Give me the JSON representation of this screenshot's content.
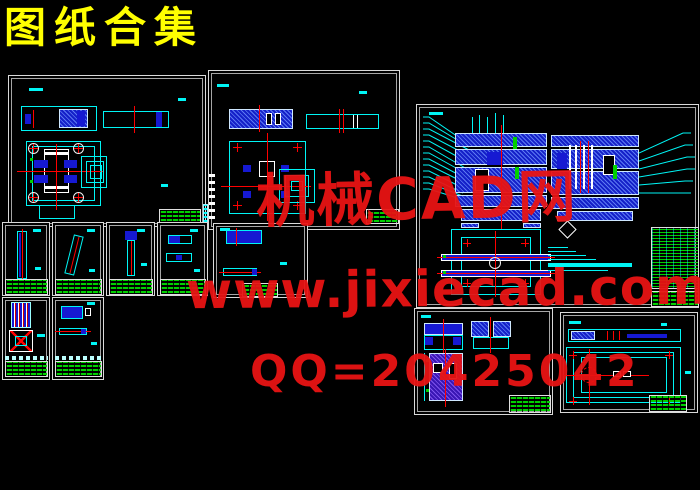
{
  "page": {
    "title": "图纸合集"
  },
  "watermarks": {
    "site_name": "机械CAD网",
    "url": "www.jixiecad.com",
    "qq": "QQ=20425042"
  },
  "canvas": {
    "width": 700,
    "height": 490,
    "sheet_count": 12
  },
  "colors": {
    "background": "#000000",
    "sheet_border": "#d9d9d9",
    "line_cyan": "#00f5f5",
    "center_red": "#ff0000",
    "fill_blue": "#1619d2",
    "table_green": "#00d000",
    "title_yellow": "#ffff00",
    "watermark_red": "#e81414"
  }
}
